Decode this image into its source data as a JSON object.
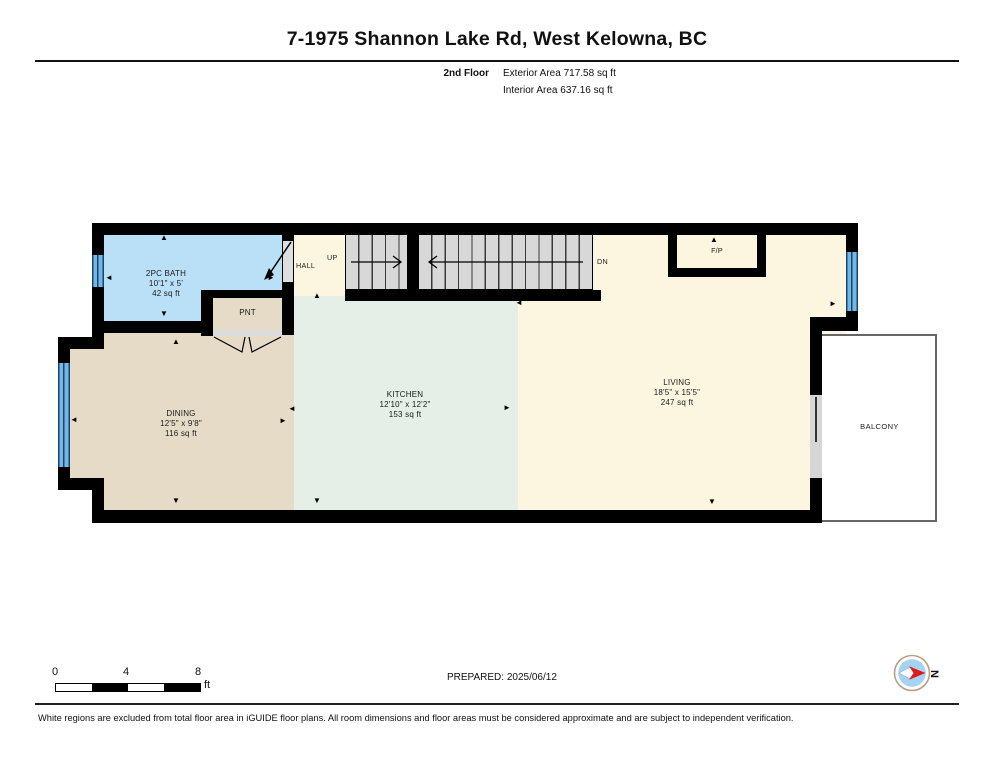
{
  "header": {
    "title": "7-1975 Shannon Lake Rd, West Kelowna, BC",
    "floor_label": "2nd Floor",
    "exterior_area": "Exterior Area 717.58 sq ft",
    "interior_area": "Interior Area 637.16 sq ft"
  },
  "rooms": {
    "bath": {
      "name": "2PC BATH",
      "dims": "10'1\" x 5'",
      "area": "42 sq ft"
    },
    "pantry": {
      "name": "PNT"
    },
    "hall": {
      "name": "HALL"
    },
    "dining": {
      "name": "DINING",
      "dims": "12'5\" x 9'8\"",
      "area": "116 sq ft"
    },
    "kitchen": {
      "name": "KITCHEN",
      "dims": "12'10\" x 12'2\"",
      "area": "153 sq ft"
    },
    "living": {
      "name": "LIVING",
      "dims": "18'5\" x 15'5\"",
      "area": "247 sq ft"
    },
    "fireplace": {
      "name": "F/P"
    },
    "balcony": {
      "name": "BALCONY"
    }
  },
  "stairs": {
    "up_label": "UP",
    "down_label": "DN"
  },
  "scale": {
    "tick0": "0",
    "tick1": "4",
    "tick2": "8",
    "unit": "ft"
  },
  "footer": {
    "prepared": "PREPARED: 2025/06/12",
    "compass_label": "N",
    "disclaimer": "White regions are excluded from total floor area in iGUIDE floor plans. All room dimensions and floor areas must be considered approximate and are subject to independent verification."
  },
  "colors": {
    "wall": "#000000",
    "bath_fill": "#b9e0f6",
    "dining_fill": "#e5dbc6",
    "kitchen_fill": "#e5efe8",
    "living_fill": "#fcf5e0",
    "stairs_fill": "#d8d8d8",
    "window_blue": "#74b7e6",
    "compass_red": "#e11a1a",
    "compass_blue": "#a6d3f2"
  }
}
